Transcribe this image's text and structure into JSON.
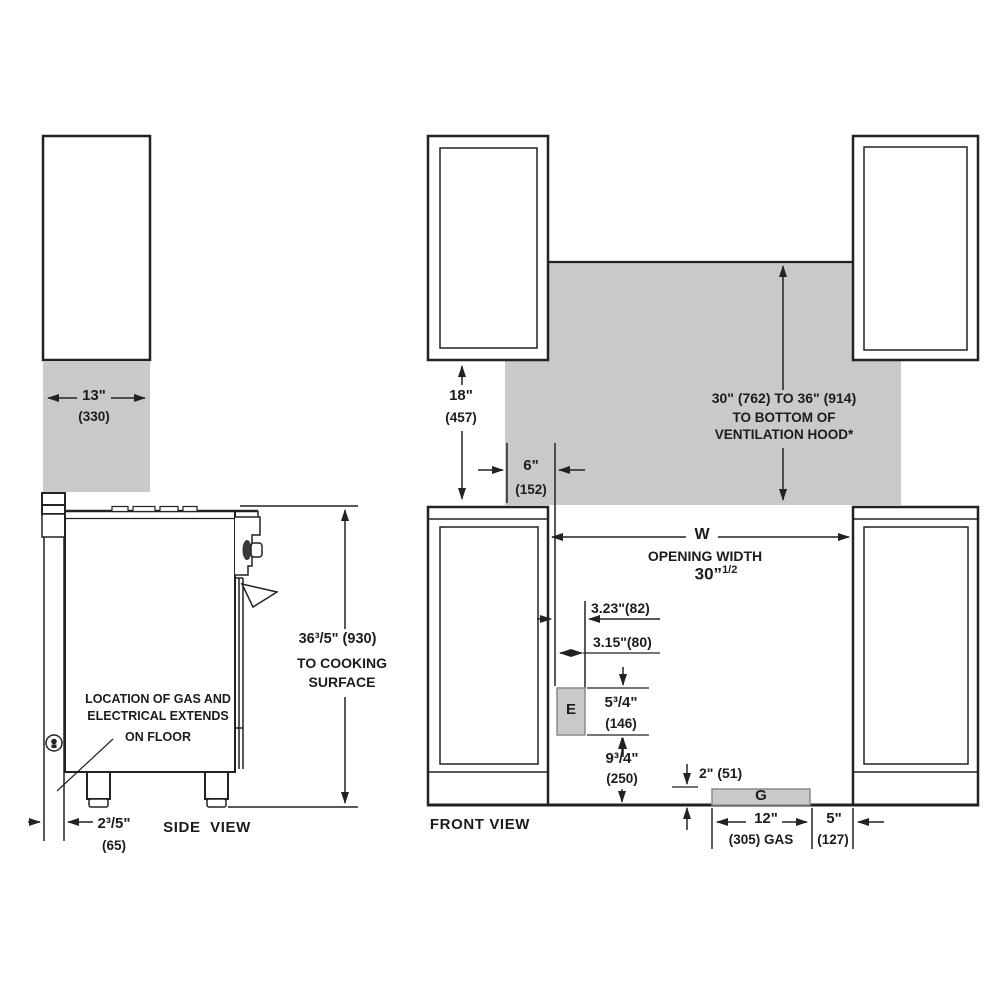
{
  "colors": {
    "line": "#222222",
    "shade_gray": "#c9c9c9",
    "box_border": "#8a8a8a",
    "text": "#1c1c1c"
  },
  "side_view": {
    "label": "SIDE  VIEW",
    "cabinet_depth": {
      "in": "13\"",
      "mm": "(330)"
    },
    "cooktop_height": {
      "line1": "36³/5\" (930)",
      "line2": "TO COOKING",
      "line3": "SURFACE"
    },
    "gas_note": [
      "LOCATION OF GAS AND",
      "ELECTRICAL EXTENDS",
      "ON FLOOR"
    ],
    "rear_gap": {
      "in": "2³/5\"",
      "mm": "(65)"
    }
  },
  "front_view": {
    "label": "FRONT VIEW",
    "counter_height": {
      "in": "18\"",
      "mm": "(457)"
    },
    "side_clearance": {
      "in": "6\"",
      "mm": "(152)"
    },
    "hood_clearance": [
      "30\" (762) TO 36\" (914)",
      "TO BOTTOM OF",
      "VENTILATION HOOD*"
    ],
    "opening_width": {
      "symbol": "W",
      "label": "OPENING WIDTH",
      "value": "30”",
      "value_sup": "1/2"
    },
    "electrical": {
      "box": "E",
      "offset_top": "3.23\"(82)",
      "offset_bottom": "3.15\"(80)",
      "box_height": {
        "in": "5³/4\"",
        "mm": "(146)"
      },
      "height_above_floor": {
        "in": "9³/4\"",
        "mm": "(250)"
      }
    },
    "gas": {
      "box": "G",
      "height": "2\" (51)",
      "width": {
        "in": "12\"",
        "mm": "(305) GAS"
      },
      "offset": {
        "in": "5\"",
        "mm": "(127)"
      }
    }
  }
}
